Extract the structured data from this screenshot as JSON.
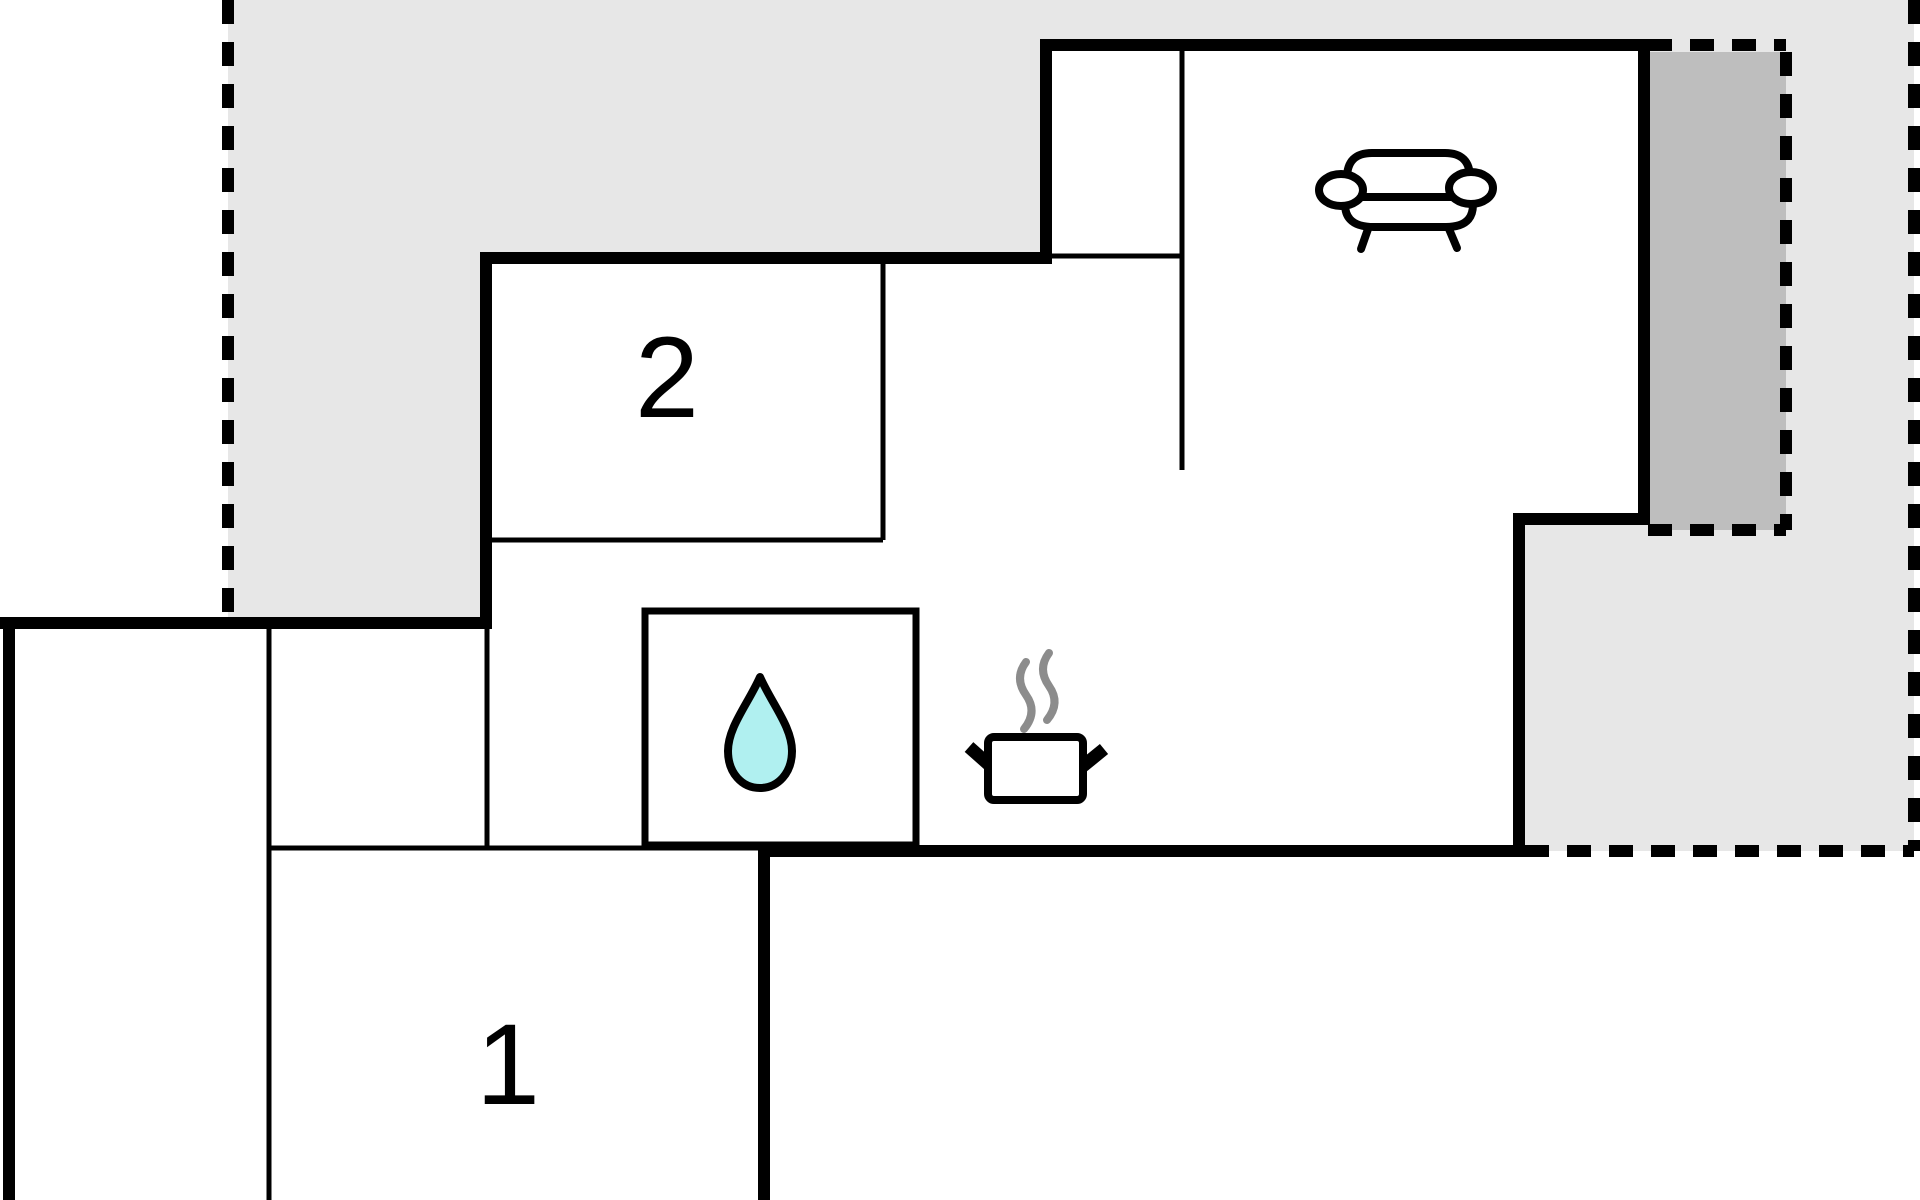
{
  "floor_plan": {
    "rooms": [
      {
        "id": "room-1",
        "label": "1"
      },
      {
        "id": "room-2",
        "label": "2"
      }
    ],
    "icons": [
      {
        "name": "sofa-icon",
        "area": "living-room"
      },
      {
        "name": "water-drop-icon",
        "area": "bathroom"
      },
      {
        "name": "steam-icon",
        "area": "kitchen"
      },
      {
        "name": "cooking-pot-icon",
        "area": "kitchen"
      }
    ],
    "colors": {
      "background": "#ffffff",
      "outdoor-light": "#e7e7e7",
      "outdoor-dark": "#bebebe",
      "wall": "#000000",
      "steam": "#8c8c8c",
      "water": "#b0f0f0"
    }
  }
}
